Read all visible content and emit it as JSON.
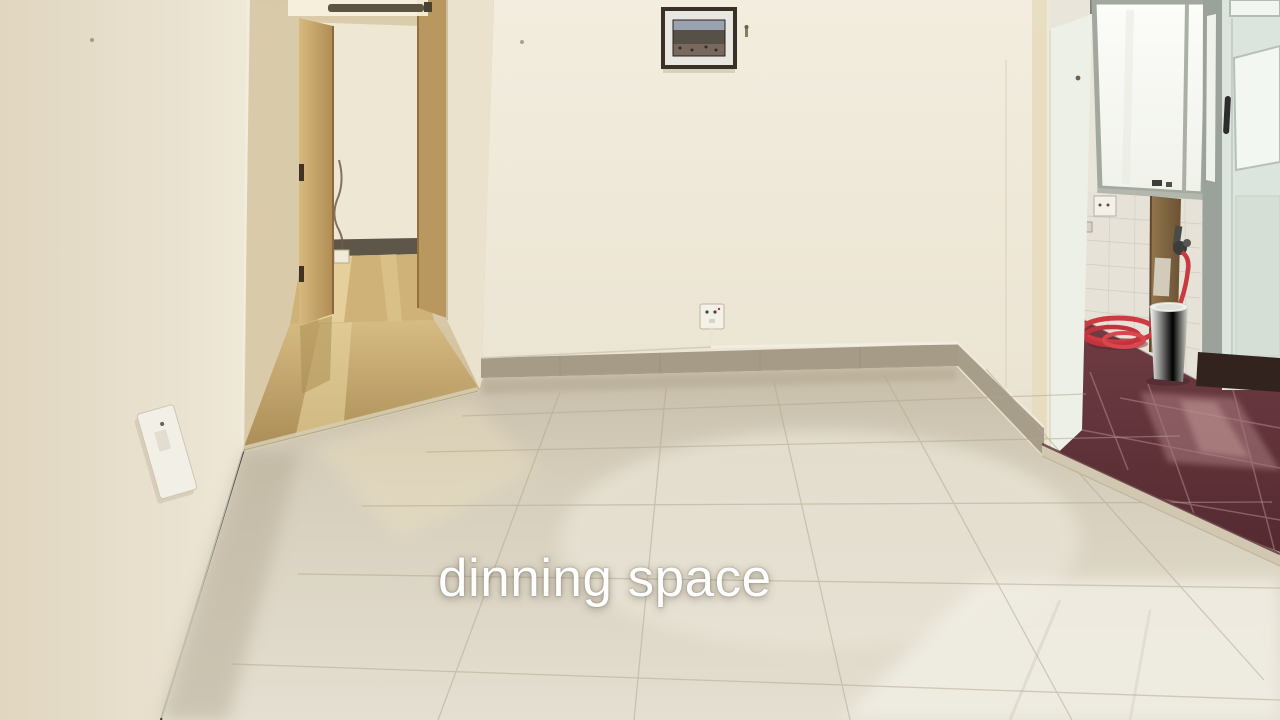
{
  "caption": {
    "text": "dinning space",
    "color": "#ffffff"
  },
  "scene": {
    "type": "interior-photo",
    "room_label": "dinning space",
    "objects": [
      "cream painted walls",
      "glossy beige floor tiles with reflections",
      "hallway opening with open tan wooden door seen edge-on",
      "tube light above hallway doorway",
      "small framed picture on back wall",
      "wall nail beside picture",
      "power socket with white conduit on back wall",
      "tilted light switch plate on left wall",
      "gray tiled skirting along back wall",
      "kitchen opening on right",
      "bright frosted kitchen window",
      "white tiled kitchen wall with socket",
      "wooden pipe board with metal water tap",
      "red hose hanging from tap and coiled on floor",
      "white plastic bucket",
      "dark maroon glossy kitchen floor tiles",
      "pale green kitchen door with glass pane and dark handle",
      "step edge between dining floor and kitchen floor"
    ],
    "palette": {
      "wall_cream": "#ece5d4",
      "wall_shadow": "#ddd2ba",
      "floor_beige": "#d8d0bd",
      "floor_bright": "#efebe0",
      "skirting_gray": "#a69b87",
      "hallway_floor_tan": "#bd9d63",
      "door_tan": "#c9a86b",
      "kitchen_floor_maroon": "#62343a",
      "window_white": "#fafaf6",
      "hose_red": "#cc3a40",
      "kitchen_door_mint": "#dce5dd"
    }
  }
}
